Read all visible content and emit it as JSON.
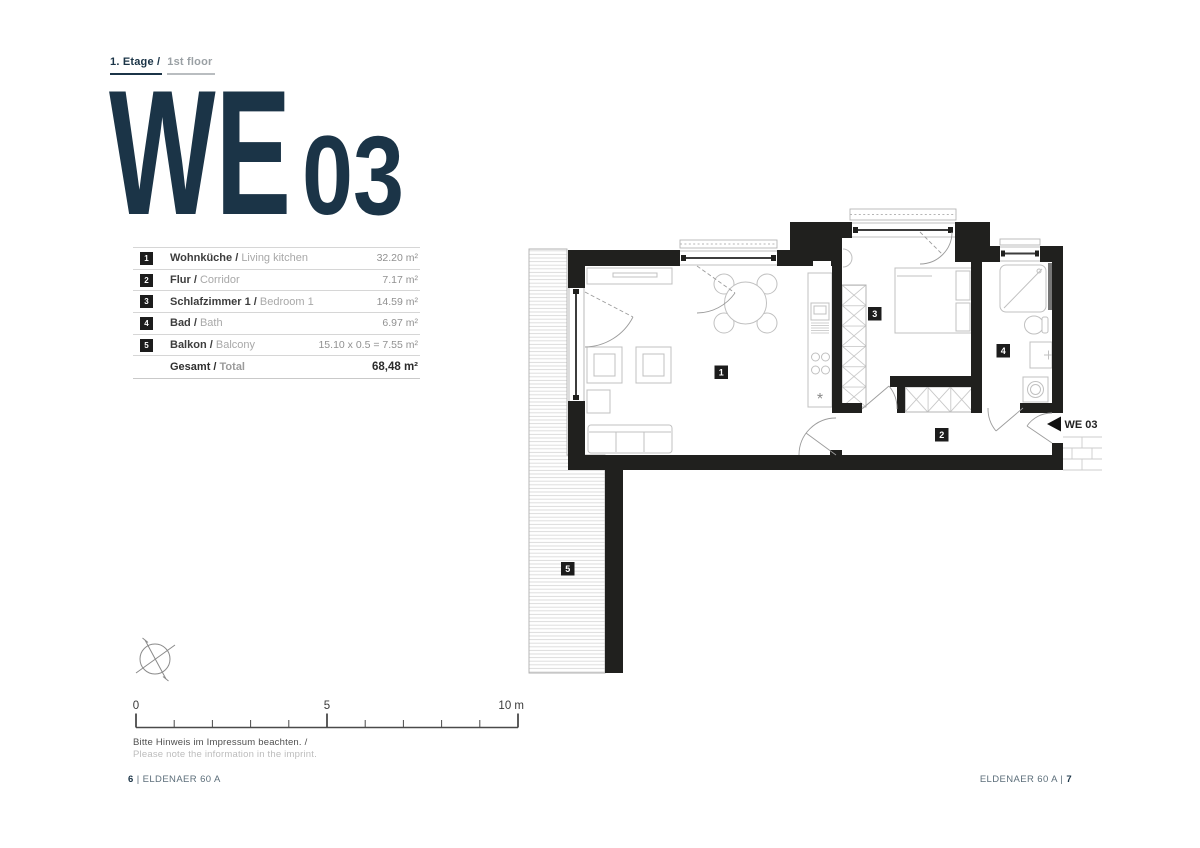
{
  "header": {
    "floor_de": "1. Etage /",
    "floor_en": "1st floor"
  },
  "title": {
    "we": "WE",
    "num": "03"
  },
  "table": {
    "rows": [
      {
        "num": "1",
        "de": "Wohnküche /",
        "en": "Living kitchen",
        "value": "32.20 m²"
      },
      {
        "num": "2",
        "de": "Flur /",
        "en": "Corridor",
        "value": "7.17 m²"
      },
      {
        "num": "3",
        "de": "Schlafzimmer 1 /",
        "en": "Bedroom 1",
        "value": "14.59 m²"
      },
      {
        "num": "4",
        "de": "Bad /",
        "en": "Bath",
        "value": "6.97 m²"
      },
      {
        "num": "5",
        "de": "Balkon /",
        "en": "Balcony",
        "value": "15.10 x 0.5 = 7.55 m²"
      }
    ],
    "total": {
      "de": "Gesamt /",
      "en": "Total",
      "value": "68,48 m²"
    }
  },
  "plan": {
    "labels": {
      "r1": "1",
      "r2": "2",
      "r3": "3",
      "r4": "4",
      "r5": "5"
    },
    "entry_label": "WE 03",
    "kitchen_symbol": "*"
  },
  "scale": {
    "t0": "0",
    "t5": "5",
    "t10": "10 m"
  },
  "note": {
    "de": "Bitte Hinweis im Impressum beachten. /",
    "en": "Please note the information in the imprint."
  },
  "footer": {
    "left_page": "6",
    "left_text": "| ELDENAER 60 A",
    "right_text": "ELDENAER 60 A |",
    "right_page": "7"
  },
  "colors": {
    "navy": "#1b3447",
    "wall": "#20201e",
    "furniture": "#c0c0c0",
    "text_gray": "#a8a8a8"
  }
}
